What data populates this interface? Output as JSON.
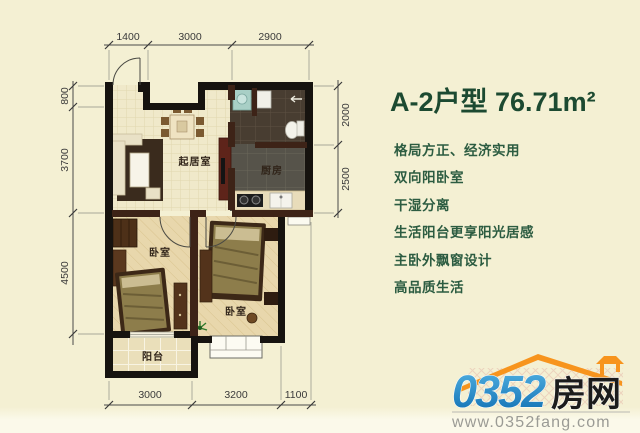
{
  "header": {
    "title": "A-2户型  76.71m²"
  },
  "features": [
    "格局方正、经济实用",
    "双向阳卧室",
    "干湿分离",
    "生活阳台更享阳光居感",
    "主卧外飘窗设计",
    "高品质生活"
  ],
  "rooms": {
    "living": "起居室",
    "kitchen": "厨房",
    "bedroom_left": "卧室",
    "bedroom_right": "卧室",
    "balcony": "阳台"
  },
  "dimensions": {
    "top": [
      "1400",
      "3000",
      "2900"
    ],
    "left": [
      "800",
      "3700",
      "4500"
    ],
    "right": [
      "2000",
      "2500"
    ],
    "bottom": [
      "3000",
      "3200",
      "1100"
    ]
  },
  "logo": {
    "number": "0352",
    "name": "房网",
    "url": "www.0352fang.com"
  },
  "colors": {
    "accent_green": "#1c4a31",
    "logo_blue": "#1586c8",
    "roof_orange": "#f7941d",
    "background_cream": "#f4f0d3"
  }
}
